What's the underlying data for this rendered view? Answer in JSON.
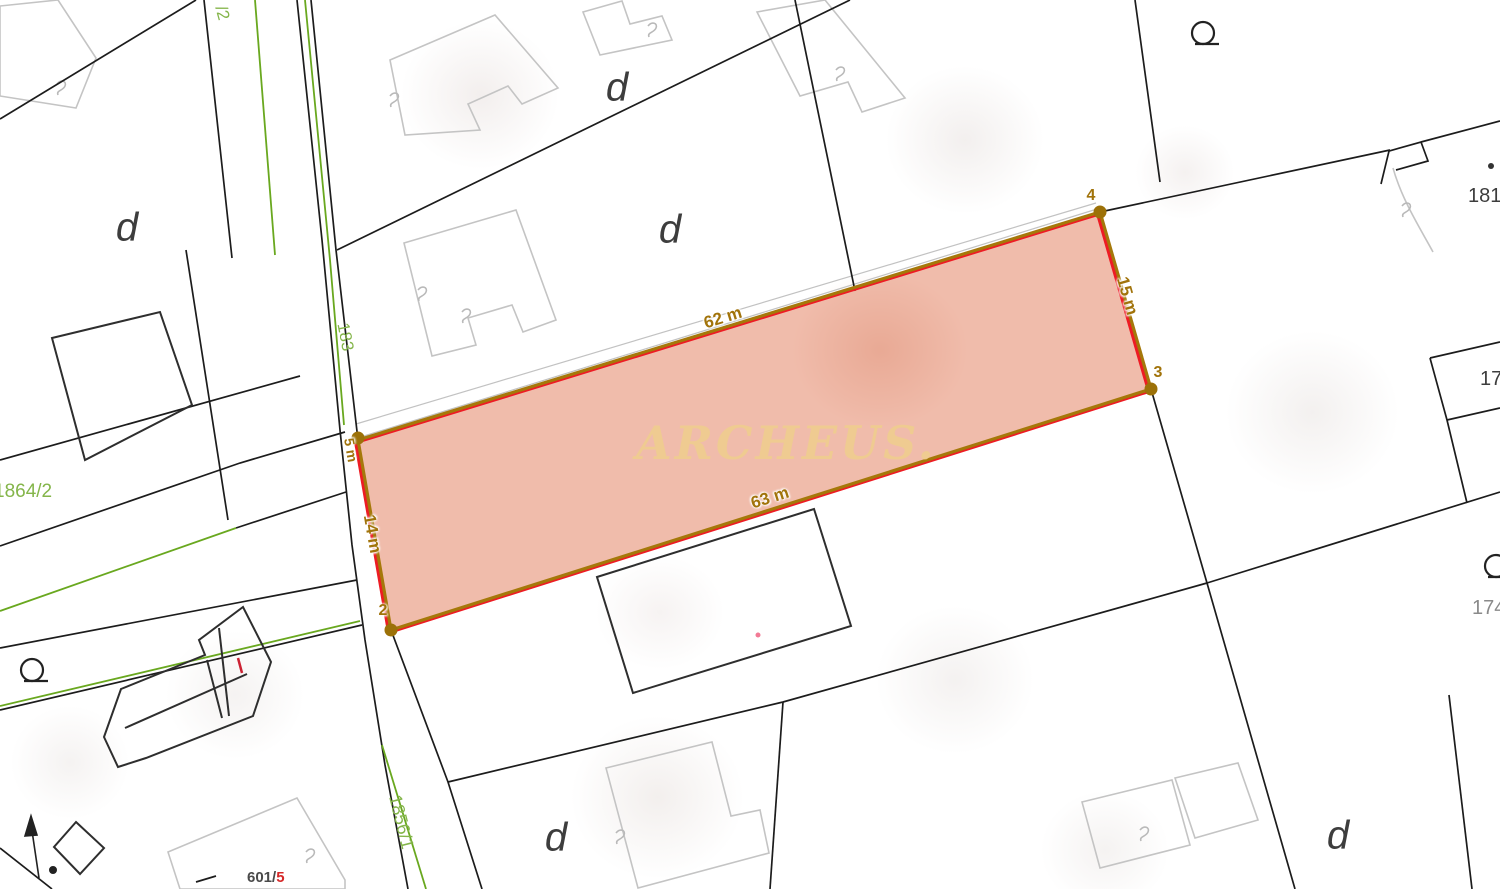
{
  "map": {
    "watermark": "ARCHEUS.",
    "measurement": {
      "edge_labels": [
        "62 m",
        "15 m",
        "63 m",
        "14 m",
        "5 m"
      ],
      "vertex_labels": [
        "4",
        "3",
        "2"
      ]
    },
    "parcel_numbers": {
      "green": [
        "/2",
        "183",
        "1864/2",
        "1856/1"
      ],
      "gray": [
        "181/",
        "17",
        "174"
      ],
      "road_bottom": {
        "prefix": "601/",
        "suffix": "5"
      }
    },
    "land_use_symbol": "d",
    "icons": {
      "q_marker": "circle-with-bar symbol",
      "north_arrow": "up arrow with dot",
      "vertex_dot": "filled gold circle"
    },
    "colors": {
      "highlight_fill": "rgba(225,122,87,0.5)",
      "boundary_gold": "#a5780a",
      "boundary_red": "#ed1c24",
      "road_green": "#69a81f",
      "label_green": "#84b54a",
      "label_gray": "#3d3d3d",
      "label_red": "#d62828",
      "watermark_gold": "rgba(238,206,140,0.85)",
      "building_gray": "#c4c4c4",
      "line_black": "#1c1c1c"
    }
  }
}
